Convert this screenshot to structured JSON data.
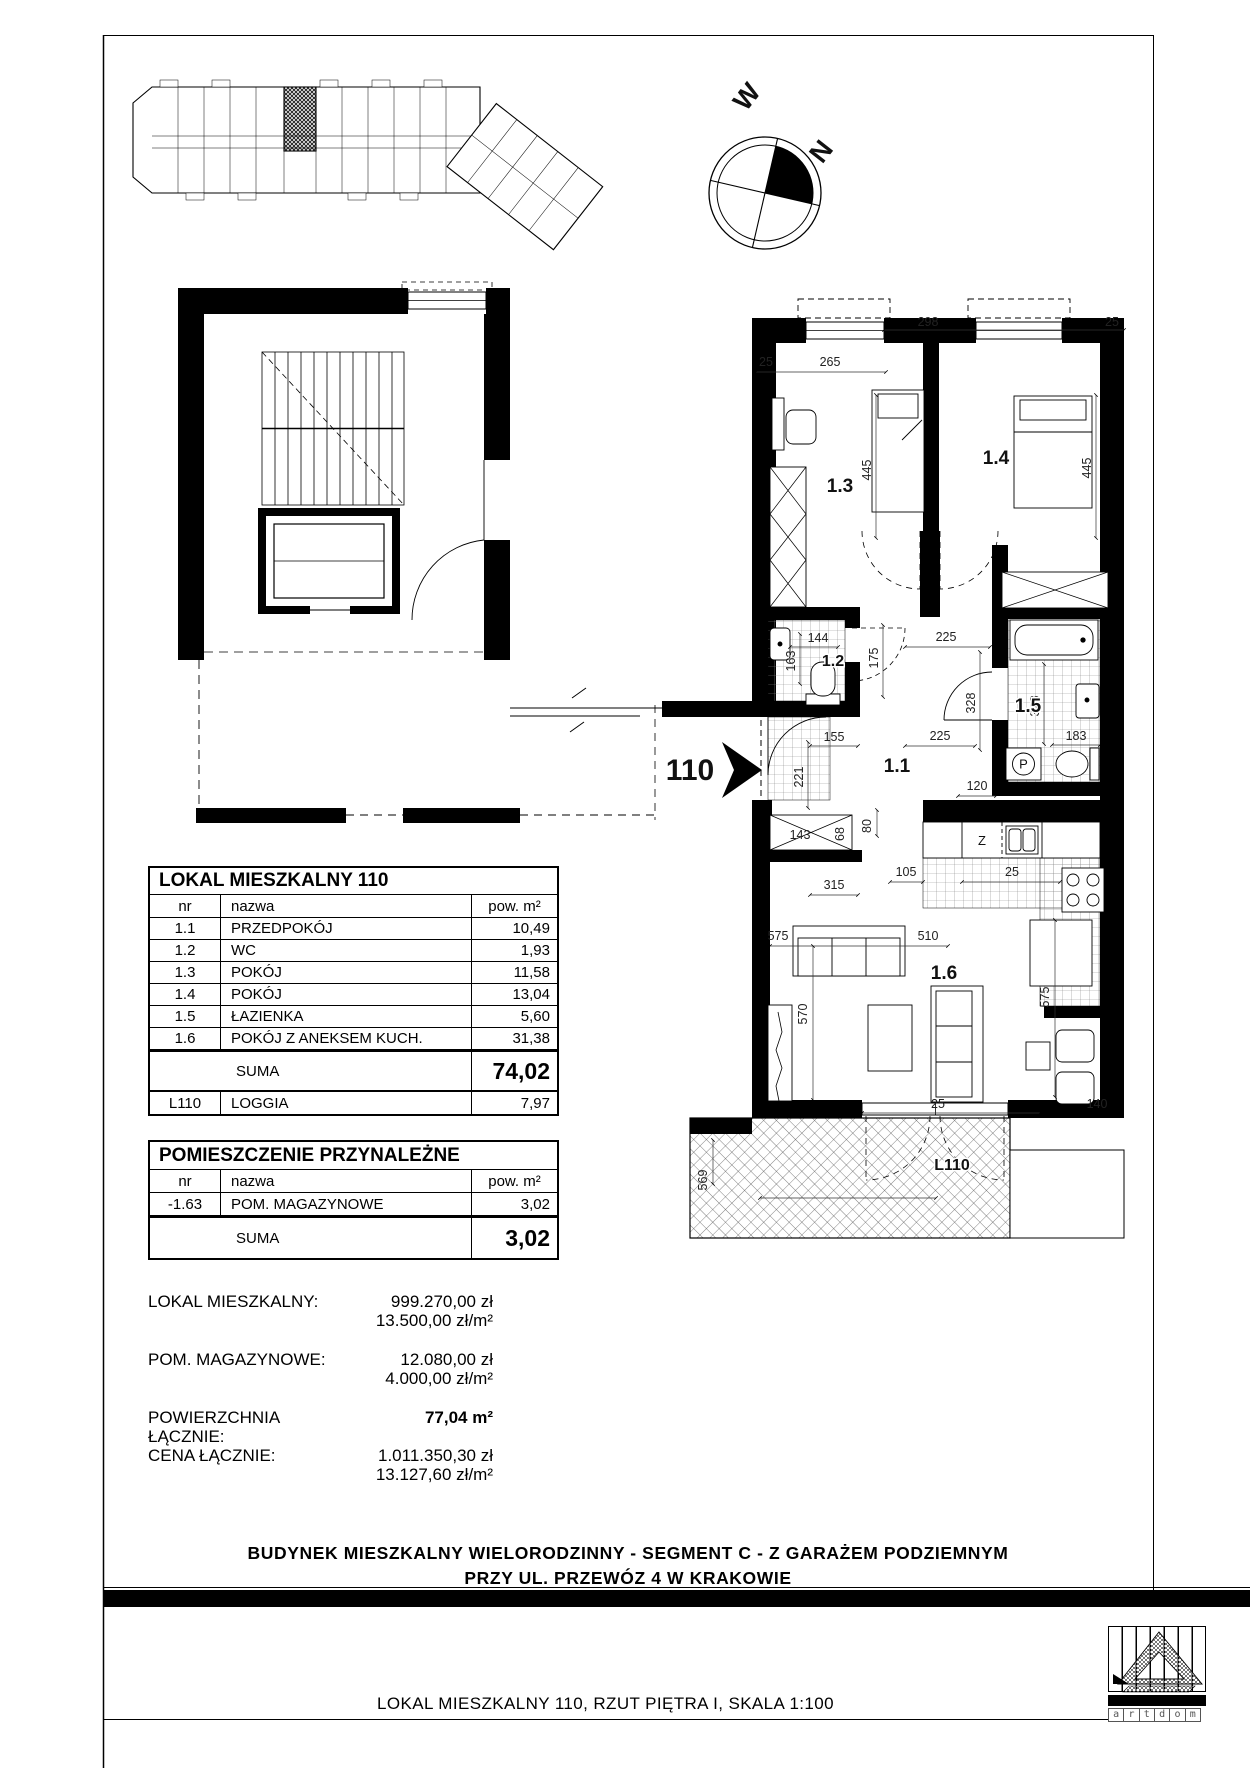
{
  "compass": {
    "west": "W",
    "north": "N"
  },
  "plan": {
    "entrance_label": "110",
    "room_labels": {
      "r11": "1.1",
      "r12": "1.2",
      "r13": "1.3",
      "r14": "1.4",
      "r15": "1.5",
      "r16": "1.6",
      "loggia": "L110"
    },
    "appliance_labels": {
      "washer": "P",
      "dishwasher": "Z"
    },
    "dims": [
      "25",
      "265",
      "298",
      "25",
      "445",
      "445",
      "144",
      "163",
      "175",
      "225",
      "328",
      "225",
      "328",
      "183",
      "155",
      "221",
      "143",
      "68",
      "120",
      "80",
      "105",
      "315",
      "25",
      "575",
      "510",
      "570",
      "575",
      "25",
      "140",
      "569"
    ]
  },
  "area_table": {
    "title": "LOKAL MIESZKALNY 110",
    "col_nr": "nr",
    "col_name": "nazwa",
    "col_area": "pow. m²",
    "rows": [
      {
        "nr": "1.1",
        "name": "PRZEDPOKÓJ",
        "area": "10,49"
      },
      {
        "nr": "1.2",
        "name": "WC",
        "area": "1,93"
      },
      {
        "nr": "1.3",
        "name": "POKÓJ",
        "area": "11,58"
      },
      {
        "nr": "1.4",
        "name": "POKÓJ",
        "area": "13,04"
      },
      {
        "nr": "1.5",
        "name": "ŁAZIENKA",
        "area": "5,60"
      },
      {
        "nr": "1.6",
        "name": "POKÓJ Z ANEKSEM KUCH.",
        "area": "31,38"
      }
    ],
    "suma_label": "SUMA",
    "suma_value": "74,02",
    "loggia_row": {
      "nr": "L110",
      "name": "LOGGIA",
      "area": "7,97"
    }
  },
  "annex_table": {
    "title": "POMIESZCZENIE PRZYNALEŻNE",
    "col_nr": "nr",
    "col_name": "nazwa",
    "col_area": "pow. m²",
    "rows": [
      {
        "nr": "-1.63",
        "name": "POM. MAGAZYNOWE",
        "area": "3,02"
      }
    ],
    "suma_label": "SUMA",
    "suma_value": "3,02"
  },
  "pricing": {
    "lokal_label": "LOKAL MIESZKALNY:",
    "lokal_price": "999.270,00 zł",
    "lokal_unit": "13.500,00 zł/m²",
    "magazyn_label": "POM. MAGAZYNOWE:",
    "magazyn_price": "12.080,00 zł",
    "magazyn_unit": "4.000,00 zł/m²",
    "area_label": "POWIERZCHNIA ŁĄCZNIE:",
    "area_value": "77,04 m²",
    "price_label": "CENA ŁĄCZNIE:",
    "price_value": "1.011.350,30 zł",
    "price_unit": "13.127,60 zł/m²"
  },
  "titles": {
    "building_line1": "BUDYNEK MIESZKALNY WIELORODZINNY - SEGMENT C - Z GARAŻEM PODZIEMNYM",
    "building_line2": "PRZY UL. PRZEWÓZ 4 W KRAKOWIE",
    "footer": "LOKAL MIESZKALNY 110, RZUT PIĘTRA I, SKALA 1:100"
  },
  "logo": {
    "letters": [
      "a",
      "r",
      "t",
      "d",
      "o",
      "m"
    ]
  }
}
